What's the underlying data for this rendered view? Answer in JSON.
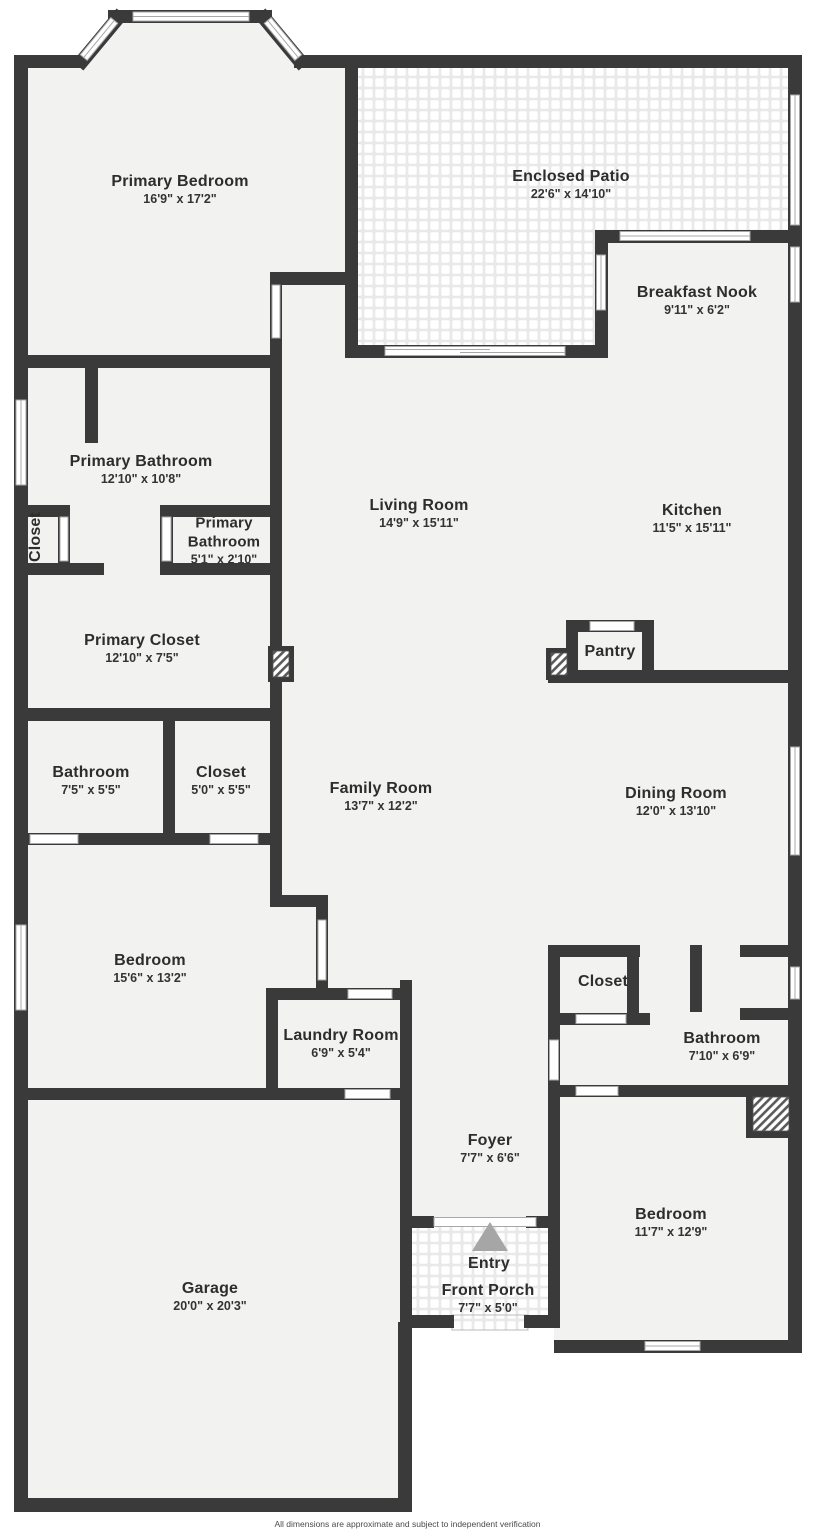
{
  "title": "Floor Plan",
  "colors": {
    "wall": "#3a3a3a",
    "floor": "#f2f2f1",
    "tile_grout": "#e9e9e9",
    "background": "#ffffff",
    "entry_arrow": "#a6a6a6",
    "window_frame": "#a8a8a8"
  },
  "icons": [
    {
      "name": "entry-arrow-icon",
      "meaning": "entry direction triangle"
    },
    {
      "name": "fireplace-hatch",
      "meaning": "hatched fixture symbol"
    }
  ],
  "rooms": [
    {
      "id": "primary-bedroom",
      "name": "Primary Bedroom",
      "dims": "16'9\" x 17'2\""
    },
    {
      "id": "enclosed-patio",
      "name": "Enclosed Patio",
      "dims": "22'6\" x 14'10\""
    },
    {
      "id": "breakfast-nook",
      "name": "Breakfast Nook",
      "dims": "9'11\" x 6'2\""
    },
    {
      "id": "primary-bathroom",
      "name": "Primary Bathroom",
      "dims": "12'10\" x 10'8\""
    },
    {
      "id": "closet-hall",
      "name": "Closet",
      "dims": ""
    },
    {
      "id": "primary-bathroom-small",
      "name": "Primary Bathroom",
      "dims": "5'1\" x 2'10\""
    },
    {
      "id": "living-room",
      "name": "Living Room",
      "dims": "14'9\" x 15'11\""
    },
    {
      "id": "kitchen",
      "name": "Kitchen",
      "dims": "11'5\" x 15'11\""
    },
    {
      "id": "pantry",
      "name": "Pantry",
      "dims": ""
    },
    {
      "id": "primary-closet",
      "name": "Primary Closet",
      "dims": "12'10\" x 7'5\""
    },
    {
      "id": "bathroom-1",
      "name": "Bathroom",
      "dims": "7'5\" x 5'5\""
    },
    {
      "id": "closet-2",
      "name": "Closet",
      "dims": "5'0\" x 5'5\""
    },
    {
      "id": "family-room",
      "name": "Family Room",
      "dims": "13'7\" x 12'2\""
    },
    {
      "id": "dining-room",
      "name": "Dining Room",
      "dims": "12'0\" x 13'10\""
    },
    {
      "id": "bedroom-2",
      "name": "Bedroom",
      "dims": "15'6\" x 13'2\""
    },
    {
      "id": "laundry-room",
      "name": "Laundry Room",
      "dims": "6'9\" x 5'4\""
    },
    {
      "id": "closet-3",
      "name": "Closet",
      "dims": ""
    },
    {
      "id": "bathroom-2",
      "name": "Bathroom",
      "dims": "7'10\" x 6'9\""
    },
    {
      "id": "foyer",
      "name": "Foyer",
      "dims": "7'7\" x 6'6\""
    },
    {
      "id": "bedroom-3",
      "name": "Bedroom",
      "dims": "11'7\" x 12'9\""
    },
    {
      "id": "garage",
      "name": "Garage",
      "dims": "20'0\" x 20'3\""
    },
    {
      "id": "entry",
      "name": "Entry",
      "dims": ""
    },
    {
      "id": "front-porch",
      "name": "Front Porch",
      "dims": "7'7\" x 5'0\""
    }
  ],
  "footer": {
    "disclaimer": "All dimensions are approximate and subject to independent verification"
  }
}
